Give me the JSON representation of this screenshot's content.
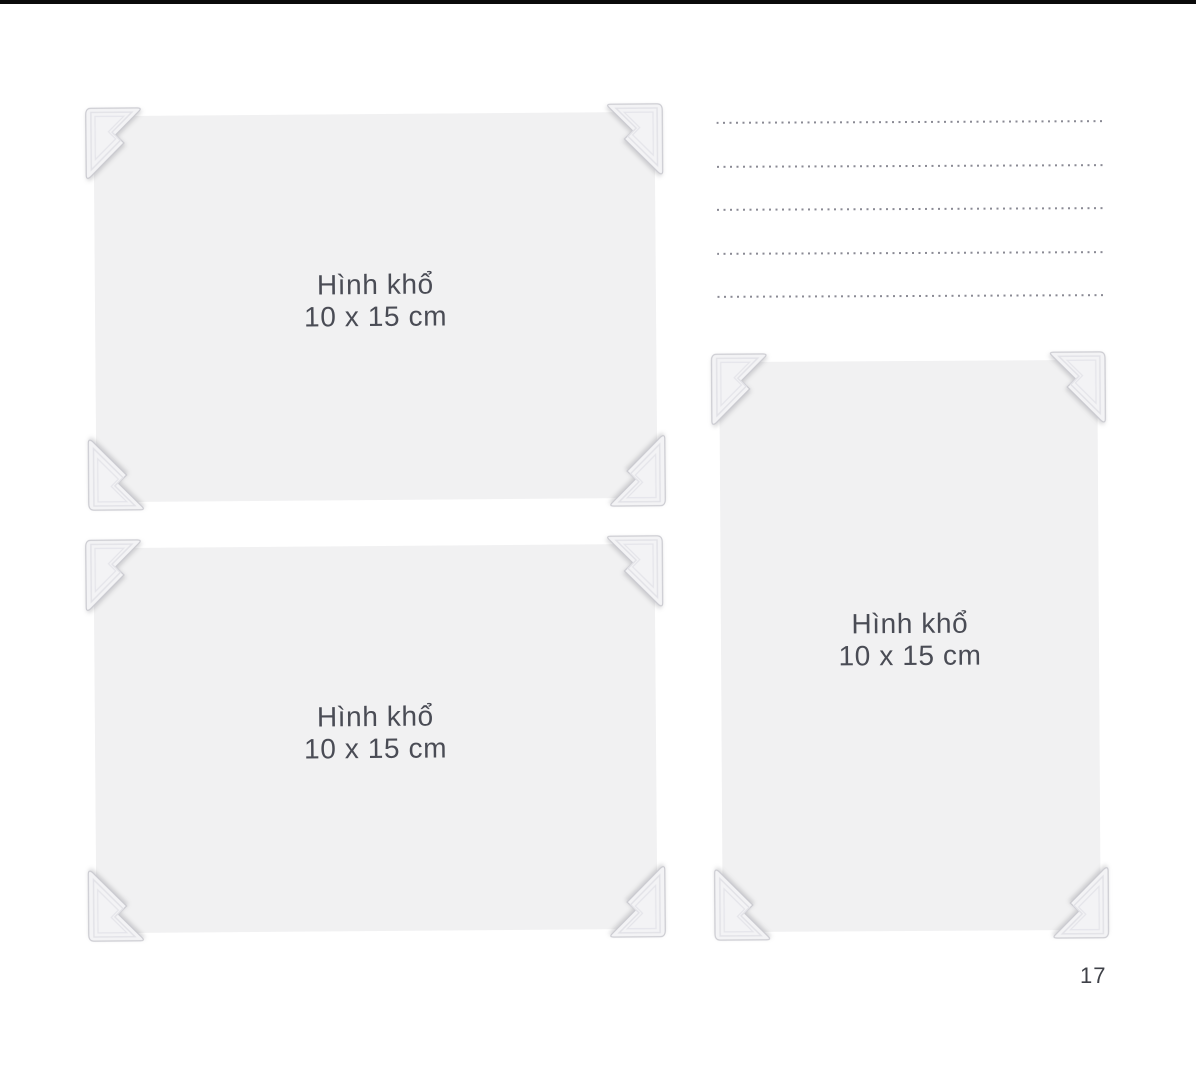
{
  "page": {
    "number": "17"
  },
  "colors": {
    "background": "#ffffff",
    "top_bar": "#0a0a0a",
    "photo_bg": "#f1f1f2",
    "corner_fill": "#f3f3f5",
    "corner_stroke": "#c9c9cf",
    "corner_ridge": "#e2e2e7",
    "label_text": "#4a4c55",
    "dots": "#8a8a94",
    "page_number_text": "#3f4148"
  },
  "frames": [
    {
      "orientation": "landscape",
      "label_line1": "Hình khổ",
      "label_line2": "10 x 15 cm"
    },
    {
      "orientation": "landscape",
      "label_line1": "Hình khổ",
      "label_line2": "10 x 15 cm"
    },
    {
      "orientation": "portrait",
      "label_line1": "Hình khổ",
      "label_line2": "10 x 15 cm"
    }
  ],
  "notes": {
    "line_count": 5
  }
}
